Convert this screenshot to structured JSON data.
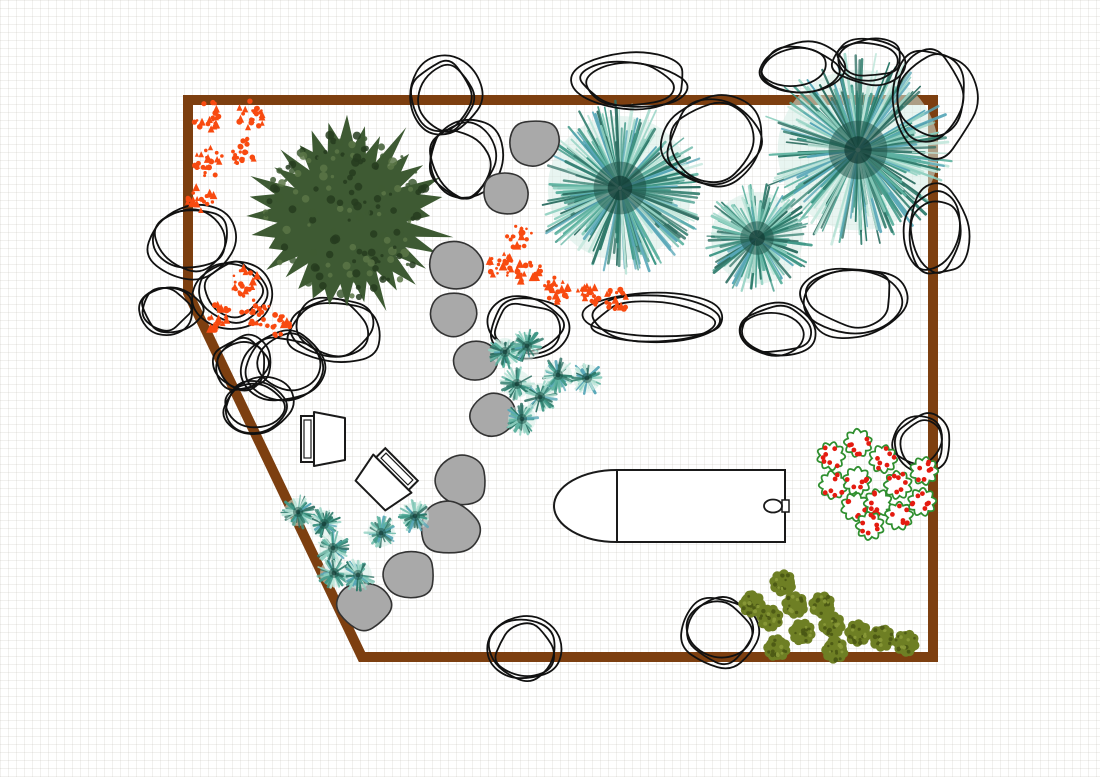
{
  "meta": {
    "app": "garden-landscape-plan",
    "canvas_width": 1100,
    "canvas_height": 777,
    "background": "#ffffff",
    "grid_size": 8
  },
  "palettes": {
    "rock_stroke": "#111111",
    "stone_fill": "#a9a9a9",
    "stone_stroke": "#333333",
    "teal": [
      "#2c7a6a",
      "#3f9887",
      "#5fb3a1",
      "#8fd0c0",
      "#bfe6da",
      "#57a7b8",
      "#2f6f63"
    ],
    "teal_base": "#d6ece5",
    "teal_core": "#1b4e44",
    "teal_core_dark": "#10362f",
    "conifer_base": "#3e5a33",
    "conifer_dark": "#263c1e",
    "conifer_light": "#5a7546",
    "orange": "#f84a10",
    "berry_outline": "#2f8f2f",
    "berry_dot": "#e41b10",
    "olive_base": "#6e7f24",
    "olive_dark": "#4a5814",
    "olive_light": "#8a9a38",
    "furniture_stroke": "#1a1a1a",
    "furniture_fill": "#ffffff"
  },
  "boundary": {
    "color": "#7d3f10",
    "stroke_width": 10,
    "points": [
      [
        188,
        100
      ],
      [
        933,
        100
      ],
      [
        933,
        657
      ],
      [
        362,
        657
      ],
      [
        188,
        293
      ]
    ]
  },
  "conifer_tree": {
    "cx": 347,
    "cy": 216,
    "r": 101,
    "seed": 7
  },
  "teal_trees": [
    {
      "cx": 620,
      "cy": 188,
      "r": 88,
      "seed": 61
    },
    {
      "cx": 858,
      "cy": 150,
      "r": 98,
      "seed": 62
    },
    {
      "cx": 757,
      "cy": 238,
      "r": 56,
      "seed": 63
    }
  ],
  "rocks_under": [
    [
      190,
      240,
      45,
      40,
      101
    ],
    [
      230,
      292,
      40,
      36,
      102
    ],
    [
      168,
      312,
      32,
      27,
      103
    ],
    [
      240,
      362,
      32,
      30,
      104
    ],
    [
      285,
      363,
      42,
      36,
      105
    ],
    [
      256,
      408,
      36,
      30,
      106
    ],
    [
      335,
      330,
      50,
      36,
      107
    ],
    [
      528,
      328,
      42,
      33,
      108
    ],
    [
      655,
      318,
      78,
      26,
      109
    ],
    [
      850,
      300,
      55,
      38,
      110
    ],
    [
      775,
      332,
      42,
      28,
      111
    ],
    [
      722,
      632,
      42,
      38,
      112
    ],
    [
      525,
      650,
      40,
      34,
      113
    ]
  ],
  "rocks_over": [
    [
      445,
      100,
      38,
      42,
      201
    ],
    [
      462,
      160,
      40,
      45,
      202
    ],
    [
      635,
      82,
      60,
      28,
      203
    ],
    [
      715,
      140,
      55,
      50,
      204
    ],
    [
      800,
      68,
      45,
      26,
      205
    ],
    [
      868,
      58,
      40,
      24,
      206
    ],
    [
      930,
      100,
      45,
      55,
      207
    ],
    [
      935,
      230,
      32,
      48,
      208
    ],
    [
      920,
      443,
      30,
      32,
      209
    ]
  ],
  "stepping_stones": [
    [
      535,
      142,
      26,
      301
    ],
    [
      504,
      194,
      24,
      302
    ],
    [
      455,
      265,
      28,
      303
    ],
    [
      454,
      314,
      25,
      304
    ],
    [
      475,
      360,
      24,
      305
    ],
    [
      492,
      416,
      25,
      306
    ],
    [
      462,
      481,
      27,
      307
    ],
    [
      449,
      528,
      31,
      308
    ],
    [
      410,
      574,
      27,
      309
    ],
    [
      364,
      606,
      28,
      310
    ]
  ],
  "orange_clusters": [
    [
      207,
      116,
      15,
      401
    ],
    [
      251,
      115,
      15,
      402
    ],
    [
      209,
      162,
      15,
      403
    ],
    [
      244,
      151,
      14,
      404
    ],
    [
      201,
      200,
      14,
      405
    ],
    [
      245,
      283,
      15,
      406
    ],
    [
      218,
      318,
      14,
      407
    ],
    [
      256,
      312,
      15,
      408
    ],
    [
      277,
      326,
      13,
      409
    ],
    [
      520,
      237,
      13,
      410
    ],
    [
      500,
      267,
      14,
      411
    ],
    [
      528,
      271,
      13,
      412
    ],
    [
      556,
      291,
      14,
      413
    ],
    [
      589,
      295,
      12,
      414
    ],
    [
      617,
      300,
      12,
      415
    ]
  ],
  "teal_plants": {
    "r": 17,
    "items": [
      [
        505,
        352
      ],
      [
        527,
        346
      ],
      [
        517,
        384
      ],
      [
        540,
        397
      ],
      [
        558,
        375
      ],
      [
        587,
        378
      ],
      [
        522,
        419
      ],
      [
        298,
        512
      ],
      [
        324,
        524
      ],
      [
        333,
        548
      ],
      [
        334,
        573
      ],
      [
        358,
        575
      ],
      [
        381,
        533
      ],
      [
        415,
        516
      ]
    ]
  },
  "berry_flowers": {
    "r": 14,
    "items": [
      [
        858,
        443
      ],
      [
        831,
        456
      ],
      [
        883,
        459
      ],
      [
        924,
        471
      ],
      [
        833,
        485
      ],
      [
        857,
        481
      ],
      [
        898,
        485
      ],
      [
        855,
        507
      ],
      [
        878,
        503
      ],
      [
        922,
        502
      ],
      [
        899,
        516
      ],
      [
        870,
        526
      ]
    ]
  },
  "olive_shrubs": {
    "r": 15,
    "items": [
      [
        783,
        583
      ],
      [
        752,
        604
      ],
      [
        795,
        605
      ],
      [
        822,
        605
      ],
      [
        770,
        618
      ],
      [
        832,
        625
      ],
      [
        802,
        632
      ],
      [
        858,
        633
      ],
      [
        882,
        638
      ],
      [
        906,
        643
      ],
      [
        777,
        648
      ],
      [
        835,
        650
      ]
    ]
  },
  "chairs": [
    {
      "cx": 323,
      "cy": 439,
      "rotation": 0
    },
    {
      "cx": 386,
      "cy": 480,
      "rotation": 135
    }
  ],
  "grill": {
    "body_x": 617,
    "body_y": 470,
    "body_w": 168,
    "body_h": 72,
    "cap_rx": 63,
    "knob_cx": 773,
    "knob_cy": 506,
    "knob_rx": 9,
    "knob_ry": 6.5,
    "notch_x": 782,
    "notch_y": 500,
    "notch_w": 7,
    "notch_h": 12
  }
}
